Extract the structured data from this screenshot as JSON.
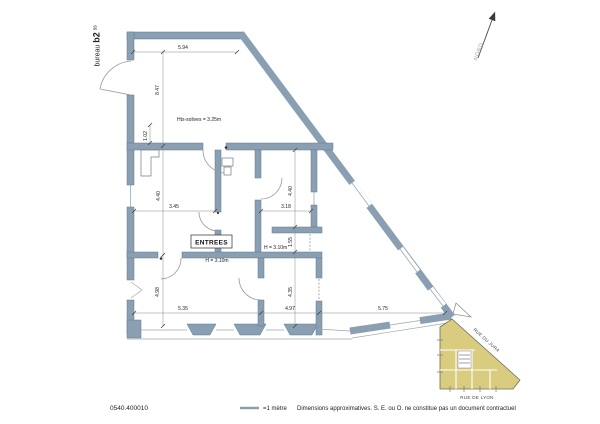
{
  "header": {
    "office_label_prefix": "bureau",
    "office_label_name": "b2",
    "office_label_suffix": "ss",
    "north_label": "NORD"
  },
  "plan": {
    "entry_label": "ENTREES",
    "ceiling_note": "Hts-solives = 3.25m",
    "height_note_1": "H = 3.10m",
    "height_note_2": "H = 3.10m",
    "dimensions": {
      "top_room_width": "5.94",
      "top_room_height": "8.47",
      "pier": "1.02",
      "room_a_height": "4.40",
      "room_a_width": "3.45",
      "room_b_height": "4.40",
      "room_b_width": "3.18",
      "room_b_sub": "1.55",
      "room_c_height": "4.98",
      "room_c_width": "5.35",
      "room_d_height": "4.35",
      "room_d_width": "4.97",
      "room_e_width": "5.75"
    }
  },
  "site_map": {
    "street_diagonal": "RUE DU JURA",
    "street_bottom": "RUE DE LYON",
    "building_fill": "#D9CC7E"
  },
  "footer": {
    "reference": "0540.400010",
    "scale_label": "=1 mètre",
    "disclaimer": "Dimensions approximatives. S. E. ou O. ne constitue pas un document contractuel"
  },
  "colors": {
    "wall": "#8AA0B2",
    "accent_line": "#8AA0B2",
    "text": "#222222"
  }
}
